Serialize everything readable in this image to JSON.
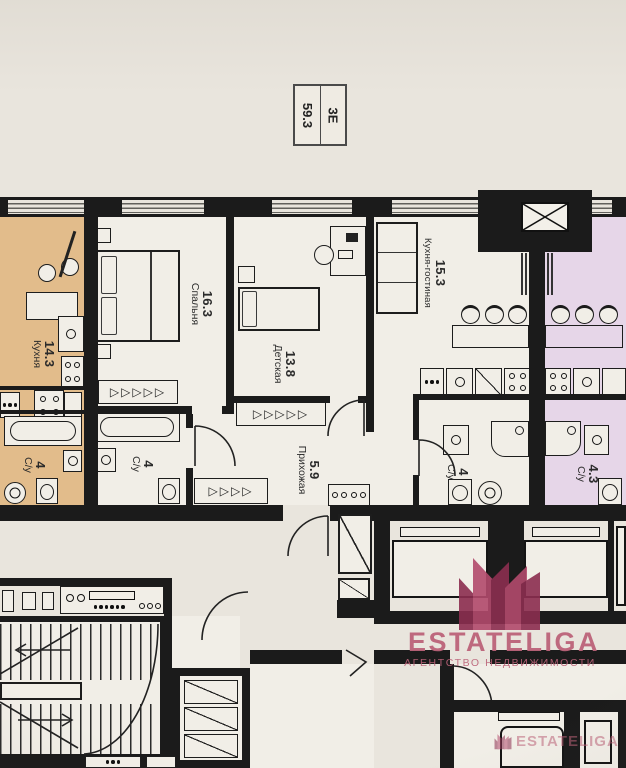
{
  "badge": {
    "area": "59.3",
    "unit_type": "3Е"
  },
  "rooms": {
    "kitchen_left": {
      "area": "14.3",
      "name": "Кухня"
    },
    "bedroom": {
      "area": "16.3",
      "name": "Спальня"
    },
    "nursery": {
      "area": "13.8",
      "name": "Детская"
    },
    "kitchen_living": {
      "area": "15.3",
      "name": "Кухня-гостиная"
    },
    "hallway": {
      "area": "5.9",
      "name": "Прихожая"
    },
    "bathroom_left": {
      "area": "4",
      "name": "С/у"
    },
    "bathroom_main": {
      "area": "4",
      "name": "С/у"
    },
    "bathroom_second": {
      "area": "4",
      "name": "С/у"
    },
    "bathroom_right": {
      "area": "4.3",
      "name": "С/у"
    }
  },
  "watermark": {
    "brand": "ESTATELIGA",
    "tagline": "АГЕНТСТВО НЕДВИЖИМОСТИ",
    "corner_brand": "ESTATELIGA"
  },
  "glyphs": {
    "closet_5": "▷▷▷▷▷",
    "closet_4": "▷▷▷▷",
    "closet_3": "▷▷▷"
  },
  "colors": {
    "paper": "#e9e5dd",
    "room": "#f1eee7",
    "wall": "#1b1b1b",
    "tan": "#e2bc8b",
    "purple": "#e6d6e8",
    "brand": "#bc6379",
    "crown_light": "#b24a6c",
    "crown_dark": "#8c2e50",
    "ink": "#2b2b2b"
  }
}
